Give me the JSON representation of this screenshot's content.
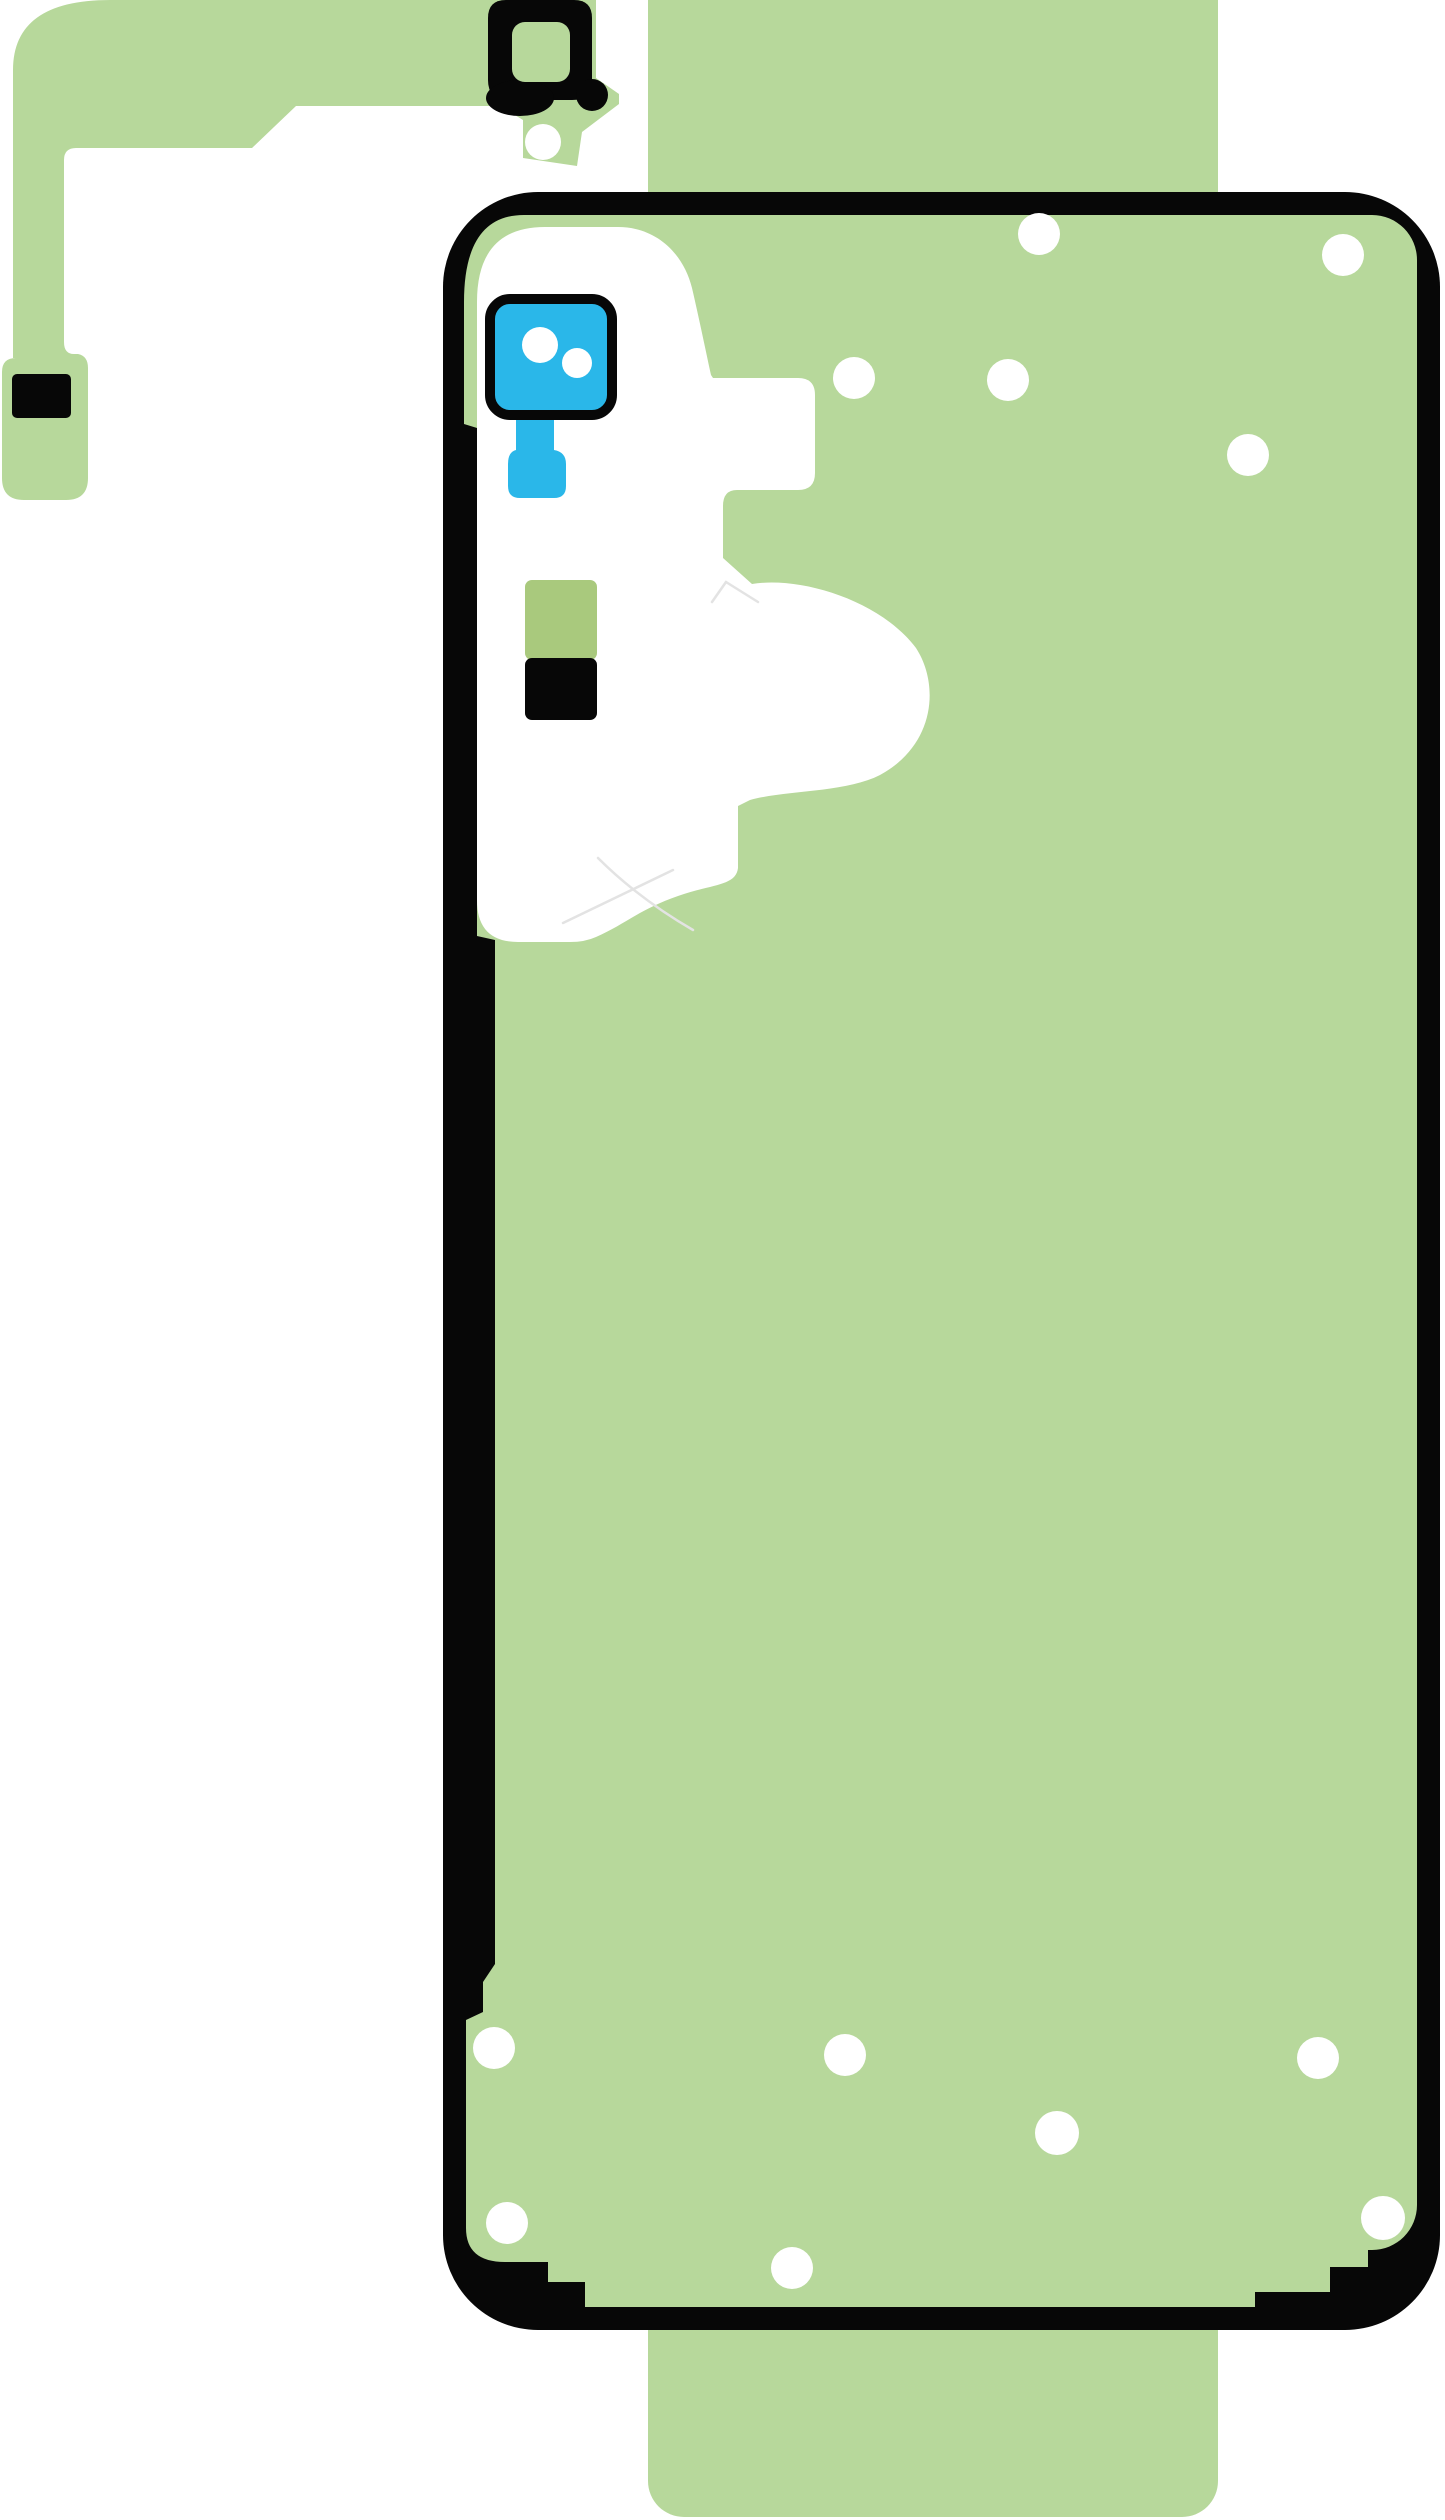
{
  "canvas": {
    "width": 1445,
    "height": 2520,
    "background": "#ffffff"
  },
  "colors": {
    "liner_green": "#b7d89b",
    "pad_green": "#a9c97d",
    "camera_blue": "#2ab7e9",
    "ink_black": "#070707",
    "hole_white": "#ffffff",
    "crease_gray": "#e3e3e3"
  },
  "parts": {
    "backing_strip": {
      "x": 648,
      "y": -40,
      "width": 570,
      "height": 2557,
      "corner_radius": 36
    },
    "flex_adhesive": {
      "alignment_hole": {
        "cx": 543,
        "cy": 142,
        "r": 18
      },
      "contact_pad": {
        "x": 12,
        "y": 374,
        "width": 59,
        "height": 44
      },
      "holes": [
        {
          "cx": 543,
          "cy": 142,
          "r": 18
        }
      ]
    },
    "camera_ring": {
      "cutout": {
        "x": 512,
        "y": 22,
        "width": 58,
        "height": 60,
        "corner_radius": 13
      }
    },
    "back_cover": {
      "outer": {
        "x": 443,
        "y": 192,
        "width": 997,
        "height": 2138,
        "corner_radius": 95
      },
      "screw_holes": [
        {
          "cx": 1039,
          "cy": 234,
          "r": 21
        },
        {
          "cx": 1343,
          "cy": 255,
          "r": 21
        },
        {
          "cx": 854,
          "cy": 378,
          "r": 21
        },
        {
          "cx": 1008,
          "cy": 380,
          "r": 21
        },
        {
          "cx": 1248,
          "cy": 455,
          "r": 21
        },
        {
          "cx": 494,
          "cy": 2048,
          "r": 21
        },
        {
          "cx": 845,
          "cy": 2055,
          "r": 21
        },
        {
          "cx": 1318,
          "cy": 2058,
          "r": 21
        },
        {
          "cx": 1057,
          "cy": 2133,
          "r": 22
        },
        {
          "cx": 1383,
          "cy": 2218,
          "r": 22
        },
        {
          "cx": 507,
          "cy": 2223,
          "r": 21
        },
        {
          "cx": 792,
          "cy": 2268,
          "r": 21
        }
      ],
      "camera_lens_sticker": {
        "frame": {
          "x": 490,
          "y": 299,
          "width": 122,
          "height": 116,
          "corner_radius": 20
        },
        "lens_dots": [
          {
            "cx": 540,
            "cy": 345,
            "r": 18
          },
          {
            "cx": 577,
            "cy": 363,
            "r": 15
          }
        ]
      },
      "battery_pad_green": {
        "x": 525,
        "y": 580,
        "width": 72,
        "height": 80
      },
      "battery_pad_black": {
        "x": 525,
        "y": 658,
        "width": 72,
        "height": 62
      }
    }
  }
}
